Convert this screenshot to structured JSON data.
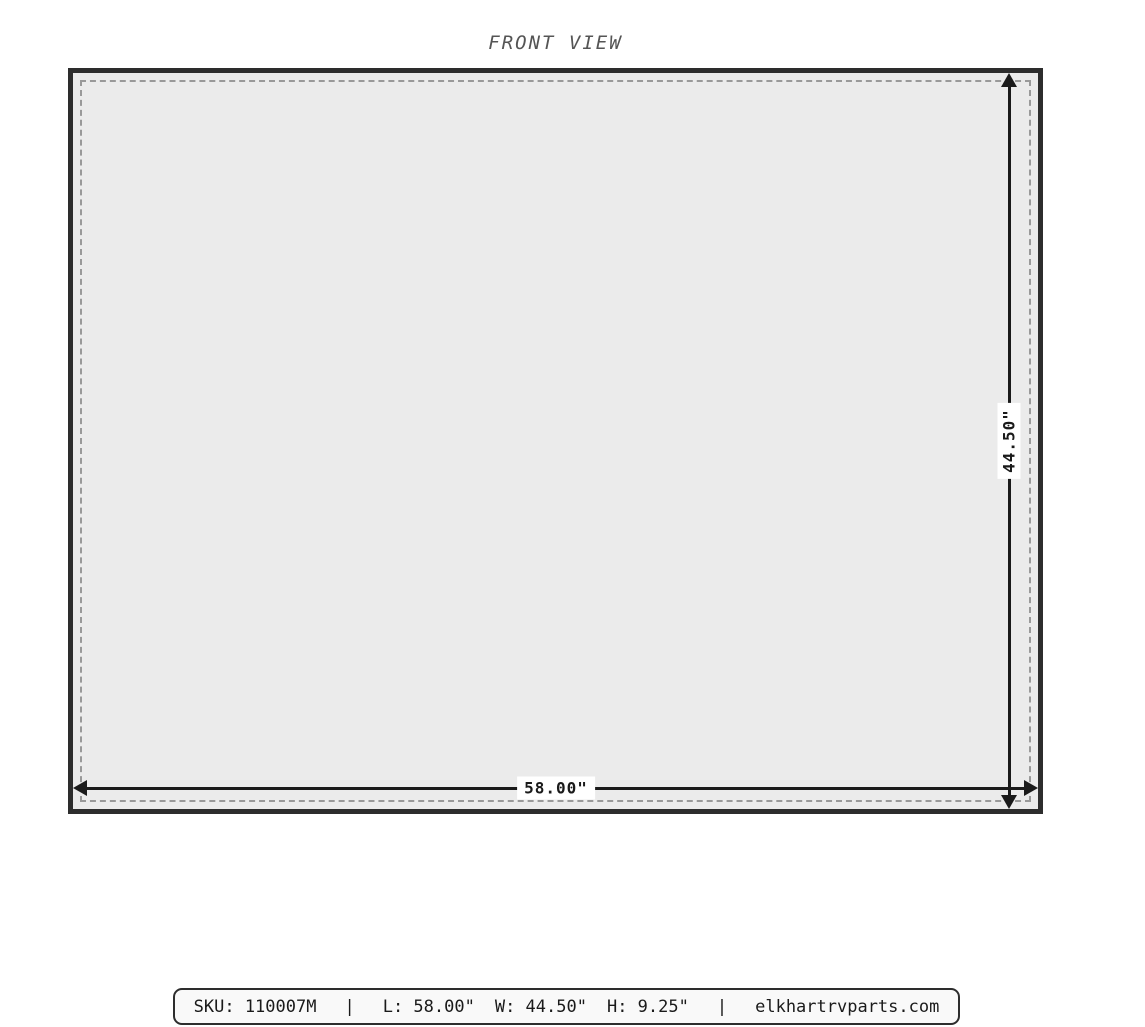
{
  "title": "FRONT VIEW",
  "diagram": {
    "width_label": "58.00\"",
    "height_label": "44.50\"",
    "fill_color": "#ebebeb",
    "border_color": "#2d2d2d",
    "dash_color": "#999999",
    "arrow_color": "#1a1a1a"
  },
  "footer": {
    "sku": "SKU: 110007M",
    "separator": "|",
    "length": "L: 58.00\"",
    "width": "W: 44.50\"",
    "height": "H: 9.25\"",
    "website": "elkhartrvparts.com"
  }
}
